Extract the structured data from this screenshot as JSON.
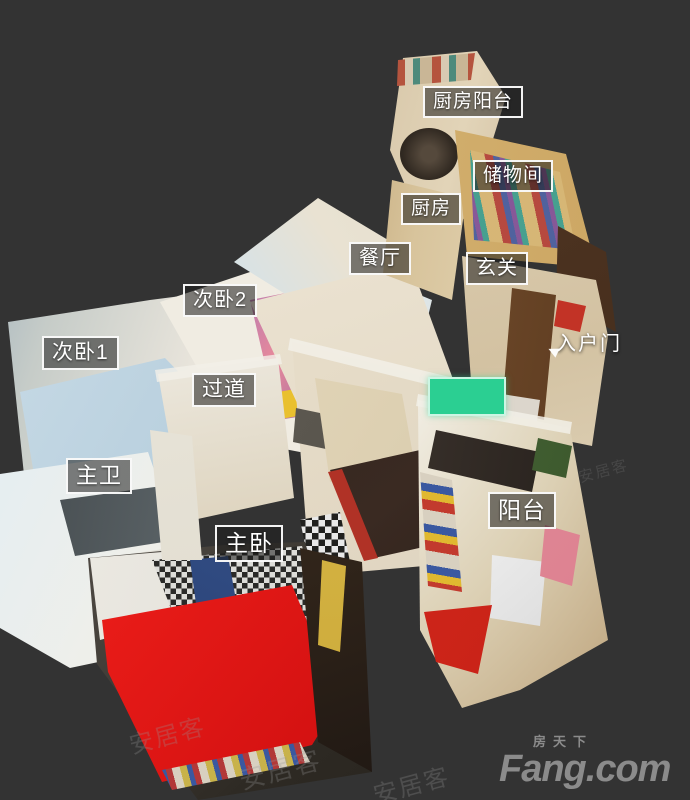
{
  "scene": {
    "app": "3d-dollhouse-room-viewer",
    "background_color": "#333333",
    "position_marker_color": "#2bcf92",
    "label_border_color": "#ffffff",
    "label_background": "rgba(28,28,28,0.55)"
  },
  "labels": [
    {
      "text": "厨房阳台"
    },
    {
      "text": "储物间"
    },
    {
      "text": "厨房"
    },
    {
      "text": "餐厅"
    },
    {
      "text": "玄关"
    },
    {
      "text": "次卧2"
    },
    {
      "text": "次卧1"
    },
    {
      "text": "过道"
    },
    {
      "text": "主卫"
    },
    {
      "text": "主卧"
    },
    {
      "text": "阳台"
    },
    {
      "text": "入户门"
    }
  ],
  "watermark": {
    "text": "安居客"
  },
  "logo": {
    "chinese": "房天下",
    "latin": "Fang.com",
    "color": "#8b8b8b"
  }
}
